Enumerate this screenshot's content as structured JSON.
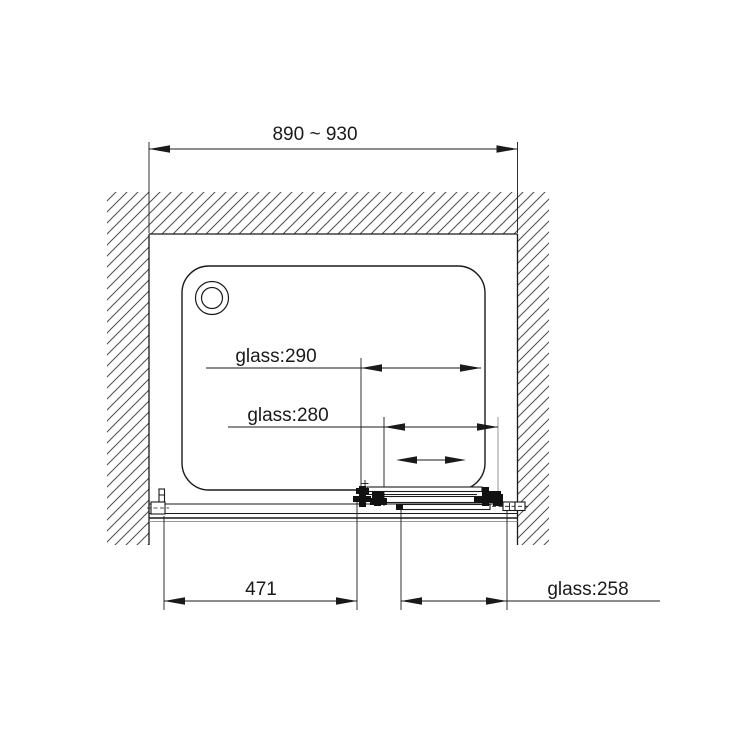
{
  "drawing": {
    "colors": {
      "line": "#1a1a1a",
      "hatch": "#4d4d4d",
      "auxiliary_gray": "#9a9a9a",
      "background": "#ffffff"
    },
    "dimensions": {
      "top_width": "890 ~ 930",
      "glass_290": "glass:290",
      "glass_280": "glass:280",
      "bottom_width": "471",
      "glass_258": "glass:258"
    }
  }
}
